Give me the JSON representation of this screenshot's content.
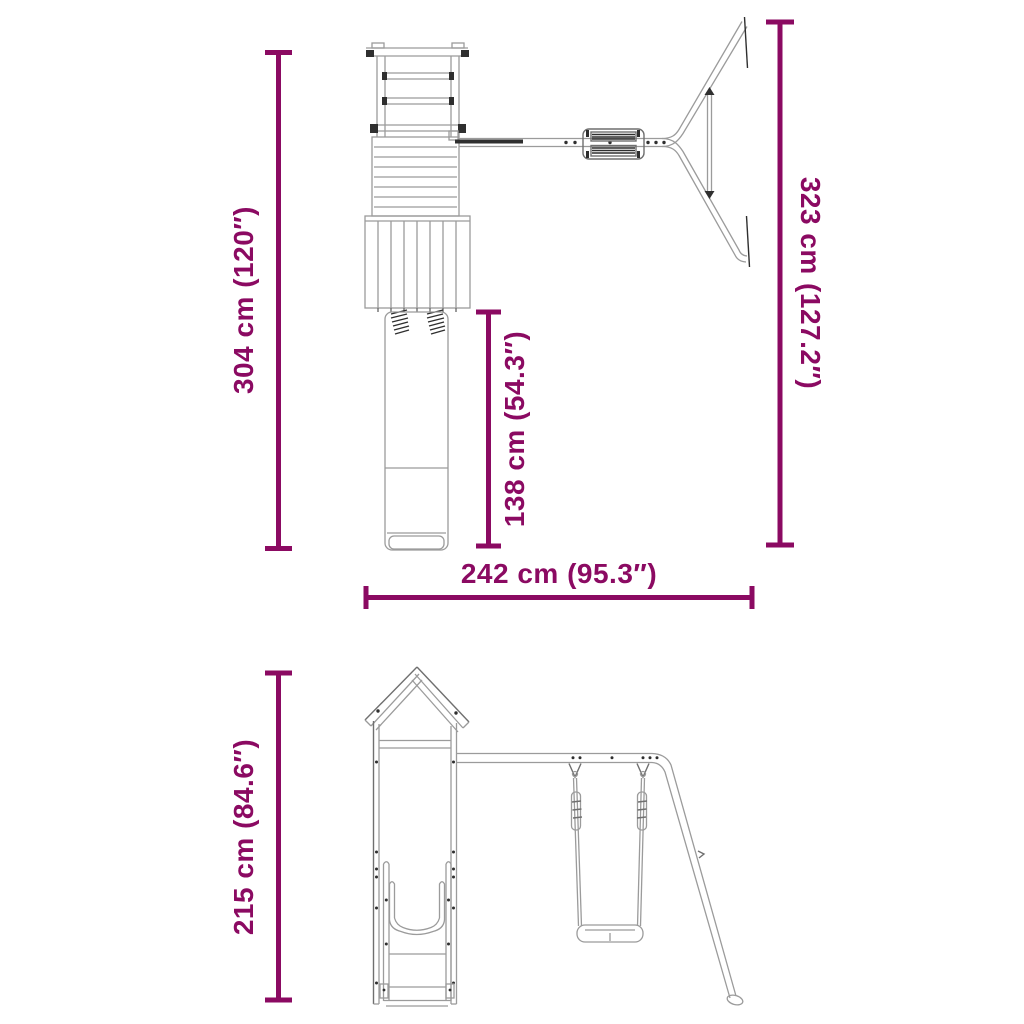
{
  "colors": {
    "dimension": "#8B0A62",
    "line_light": "#9B9B9B",
    "line_medium": "#6F6F6F",
    "line_dark": "#2F2F2F",
    "background": "#FFFFFF"
  },
  "views": {
    "plan": {
      "name": "playset plan view (top-down)",
      "labels": {
        "depth_total": "304 cm (120″)",
        "frame_span": "323 cm (127.2″)",
        "slide_length": "138 cm (54.3″)",
        "width_total": "242 cm (95.3″)"
      }
    },
    "front": {
      "name": "playset front view",
      "labels": {
        "height_total": "215 cm (84.6″)"
      }
    }
  }
}
